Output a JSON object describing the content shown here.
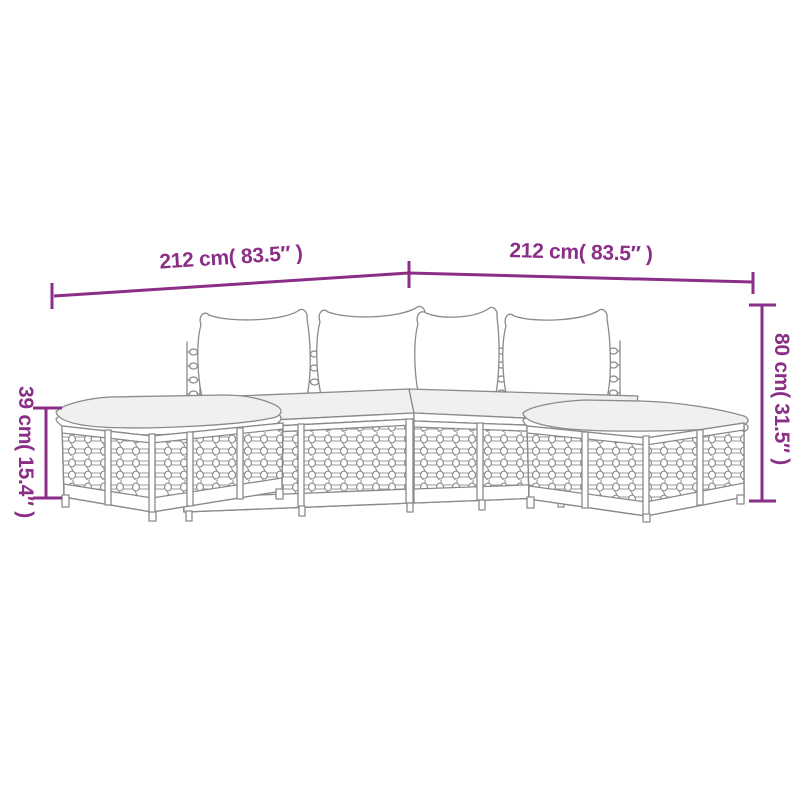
{
  "colors": {
    "accent": "#8b2e87",
    "line": "#8a8a8a",
    "cushion": "#f0f0ee",
    "bg": "#ffffff"
  },
  "illustration": {
    "aria_label": "Line drawing of a modular poly rattan garden lounge set: two footstool ottomans with cushions and middle sofa sections with backrest cushions, arranged in an L-shape"
  },
  "dimensions": {
    "top_left": {
      "label": "212 cm( 83.5″ )"
    },
    "top_right": {
      "label": "212 cm( 83.5″ )"
    },
    "right_side": {
      "label": "80 cm( 31.5″ )"
    },
    "left_side": {
      "label": "39 cm( 15.4″ )"
    }
  }
}
